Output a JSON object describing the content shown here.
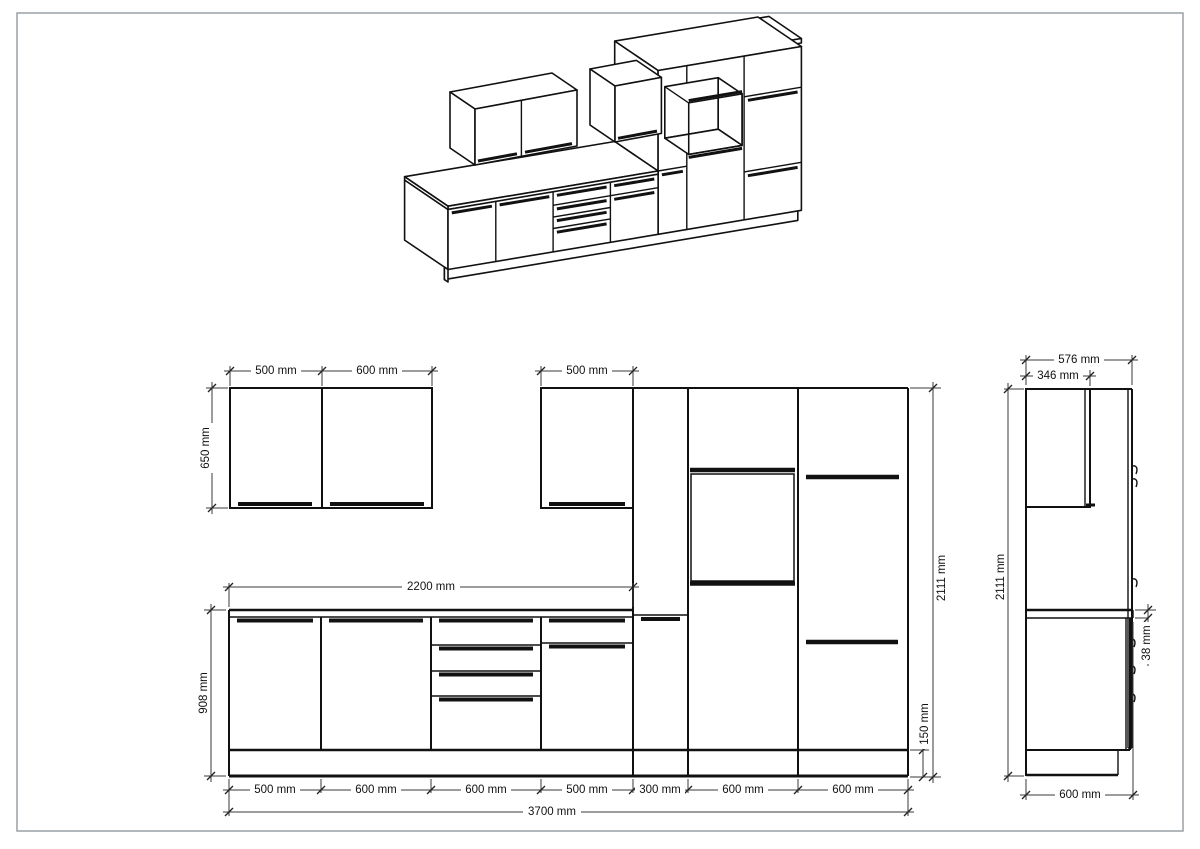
{
  "page": {
    "background": "#ffffff",
    "border_color": "#9aa0a6",
    "line_color": "#111111",
    "drawing_type": "kitchen cabinet technical drawing"
  },
  "front_elevation": {
    "wall_left_width_1": "500 mm",
    "wall_left_width_2": "600 mm",
    "wall_mid_width": "500 mm",
    "wall_height": "650 mm",
    "counter_length": "2200 mm",
    "base_height": "908 mm",
    "total_height": "2111 mm",
    "plinth_height": "150 mm",
    "unit_widths": [
      "500 mm",
      "600 mm",
      "600 mm",
      "500 mm",
      "300 mm",
      "600 mm",
      "600 mm"
    ],
    "total_width": "3700 mm"
  },
  "side_elevation": {
    "total_depth": "576 mm",
    "wall_depth": "346 mm",
    "total_height": "2111 mm",
    "worktop_thickness": "38 mm",
    "base_depth": "600 mm"
  }
}
